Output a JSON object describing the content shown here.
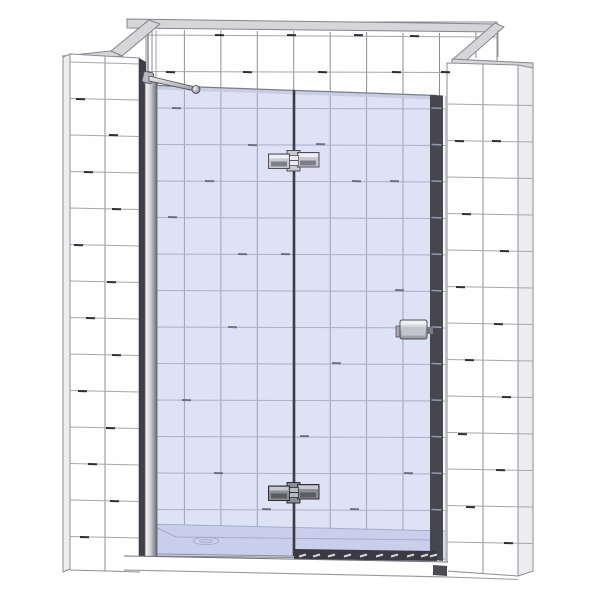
{
  "scene": {
    "title": "Frameless hinged glass shower door in a white tiled alcove (3D CAD product render)",
    "components": {
      "back_wall": "tiled back wall",
      "left_wall": "tiled left wall pillar",
      "right_wall": "tiled right wall pillar",
      "top_band": "wall top trim band",
      "fixed_panel": "fixed inline glass panel",
      "door_panel": "hinged glass door",
      "top_hinge": "top pivot hinge",
      "bottom_hinge": "bottom pivot hinge",
      "handle": "door knob handle",
      "support_bar": "wall-to-glass support bar",
      "wall_profile": "wall mounting profile",
      "tray": "low-profile shower tray",
      "drain": "tray drain cover",
      "bottom_seal": "door bottom seal strip"
    }
  },
  "colors": {
    "tile": "#fefefe",
    "side_face": "#ededf0",
    "wall_outline": "#8e8e96",
    "grout": "#a6a6ae",
    "grout_v": "#8e8e96",
    "grout_dark": "#2e2e34",
    "band": "#d6d6d8",
    "band_edge": "#85858d",
    "glass_tint": "rgba(178,188,234,0.42)",
    "glass_edge": "#c4c9e0",
    "glass_dash": "#50566e",
    "edge_dark": "#46464e",
    "edge_tick": "#8f95ab",
    "shadow": "#3f3f46",
    "outline": "#4e4e56",
    "chrome_light": "#f0f0f3",
    "chrome_mid": "#c9c9d1",
    "chrome_dark": "#7e7e88",
    "tray": "#dadded",
    "tray_rim": "#9aa0b4",
    "seal": "#3a3a40",
    "seal_dash": "#d6d6de"
  },
  "texture": {
    "wall_dashes": [
      [
        215,
        35
      ],
      [
        287,
        35
      ],
      [
        354,
        35
      ],
      [
        410,
        36
      ],
      [
        166,
        72
      ],
      [
        243,
        72
      ],
      [
        318,
        72
      ],
      [
        392,
        72
      ],
      [
        441,
        72
      ],
      [
        76,
        99
      ],
      [
        109,
        135
      ],
      [
        84,
        172
      ],
      [
        112,
        209
      ],
      [
        74,
        245
      ],
      [
        107,
        282
      ],
      [
        86,
        318
      ],
      [
        112,
        355
      ],
      [
        78,
        391
      ],
      [
        106,
        428
      ],
      [
        88,
        464
      ],
      [
        110,
        501
      ],
      [
        80,
        537
      ],
      [
        455,
        141
      ],
      [
        492,
        141
      ],
      [
        462,
        214
      ],
      [
        500,
        251
      ],
      [
        456,
        287
      ],
      [
        494,
        324
      ],
      [
        465,
        360
      ],
      [
        502,
        397
      ],
      [
        458,
        434
      ],
      [
        496,
        470
      ],
      [
        466,
        507
      ],
      [
        504,
        543
      ]
    ],
    "glass_dashes": [
      [
        172,
        108
      ],
      [
        248,
        145
      ],
      [
        316,
        144
      ],
      [
        205,
        181
      ],
      [
        352,
        181
      ],
      [
        390,
        181
      ],
      [
        168,
        217
      ],
      [
        238,
        254
      ],
      [
        281,
        254
      ],
      [
        395,
        290
      ],
      [
        228,
        327
      ],
      [
        332,
        363
      ],
      [
        182,
        400
      ],
      [
        300,
        436
      ],
      [
        404,
        473
      ],
      [
        214,
        473
      ],
      [
        262,
        509
      ],
      [
        350,
        509
      ]
    ],
    "edge_ticks_y": [
      108,
      144.5,
      181,
      217.5,
      254,
      290.5,
      327,
      363.5,
      400,
      436.5,
      473,
      509.5
    ],
    "seal_dashes_x": [
      299,
      313,
      328,
      344,
      360,
      376,
      391,
      407,
      421,
      430
    ]
  }
}
